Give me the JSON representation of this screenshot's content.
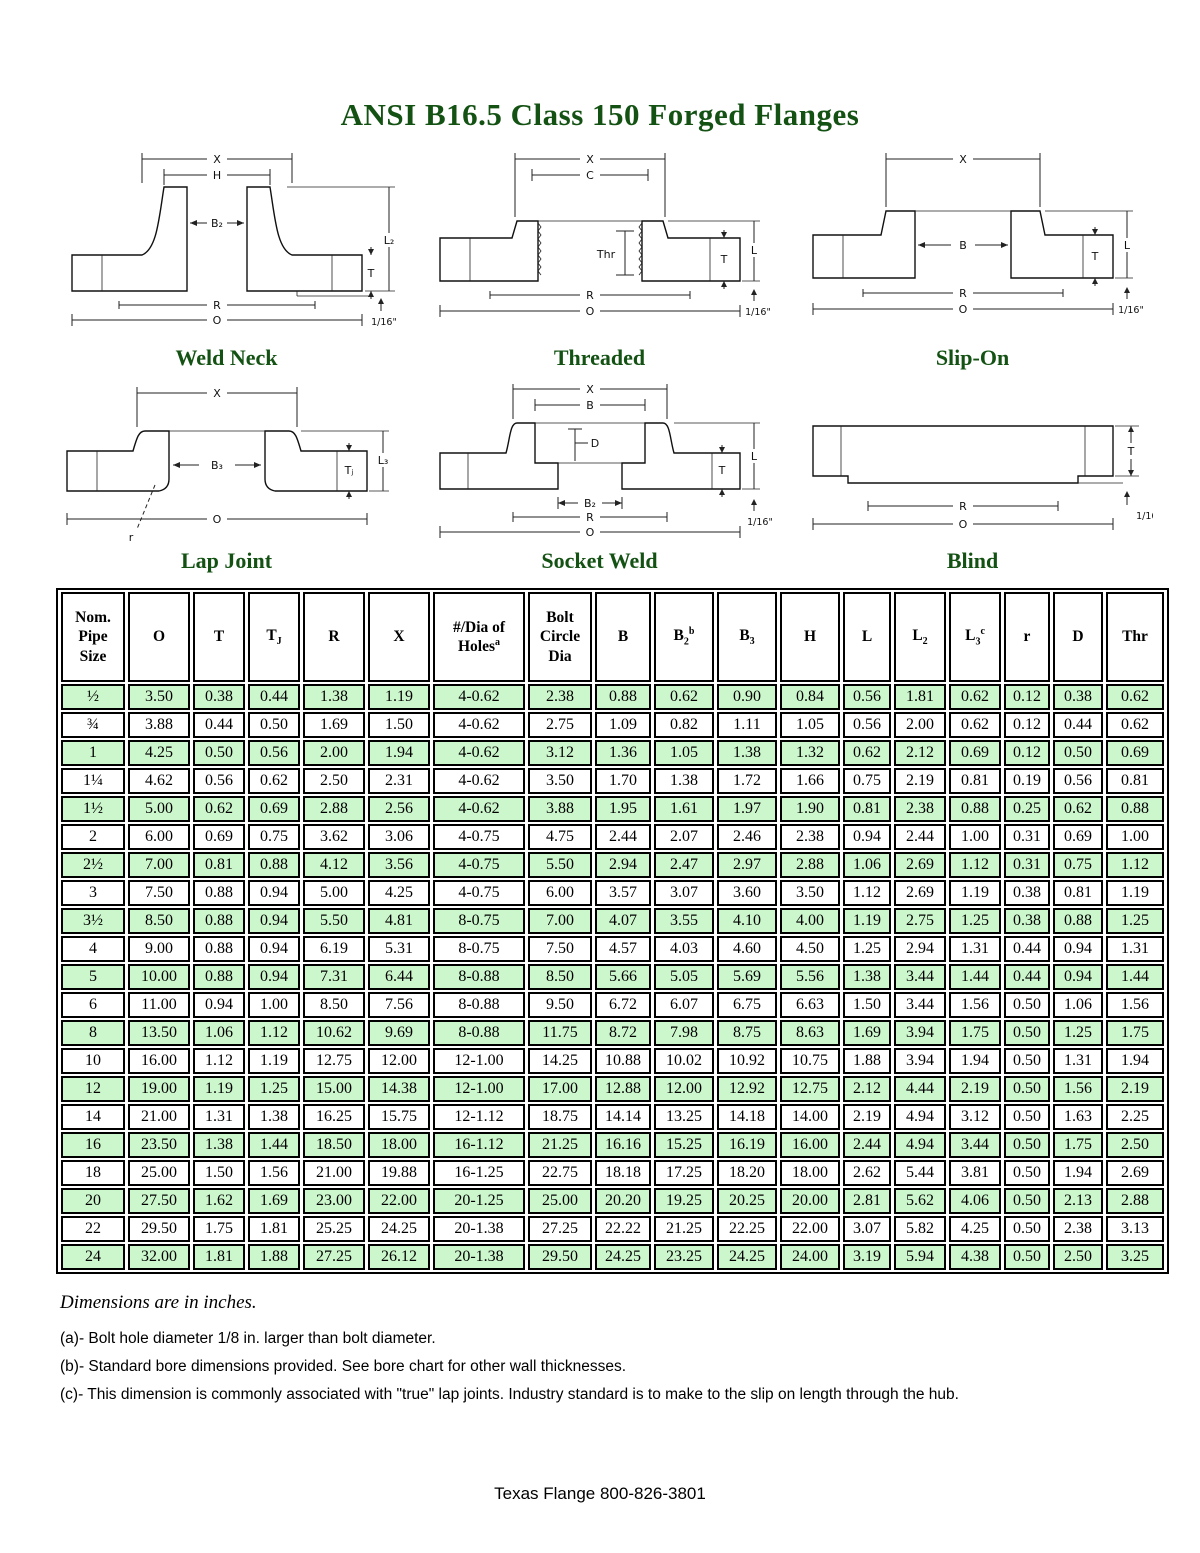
{
  "title": "ANSI B16.5 Class 150 Forged Flanges",
  "colors": {
    "heading_green": "#145214",
    "row_green": "#ccf7cc",
    "border": "#000000"
  },
  "diagrams": [
    {
      "caption": "Weld Neck",
      "labels": {
        "x": "X",
        "h": "H",
        "b2": "B₂",
        "l2": "L₂",
        "t": "T",
        "r": "R",
        "o": "O",
        "rf": "1/16\""
      }
    },
    {
      "caption": "Threaded",
      "labels": {
        "x": "X",
        "c": "C",
        "thr": "Thr",
        "t": "T",
        "l": "L",
        "r": "R",
        "o": "O",
        "rf": "1/16\""
      }
    },
    {
      "caption": "Slip-On",
      "labels": {
        "x": "X",
        "b": "B",
        "t": "T",
        "l": "L",
        "r": "R",
        "o": "O",
        "rf": "1/16\""
      }
    },
    {
      "caption": "Lap Joint",
      "labels": {
        "x": "X",
        "b3": "B₃",
        "tj": "Tⱼ",
        "l3": "L₃",
        "o": "O",
        "r": "r"
      }
    },
    {
      "caption": "Socket Weld",
      "labels": {
        "x": "X",
        "b": "B",
        "d": "D",
        "b2": "B₂",
        "r": "R",
        "o": "O",
        "t": "T",
        "l": "L",
        "rf": "1/16\""
      }
    },
    {
      "caption": "Blind",
      "labels": {
        "t": "T",
        "r": "R",
        "o": "O",
        "rf": "1/16\""
      }
    }
  ],
  "table": {
    "headers": [
      {
        "base": "Nom. Pipe Size"
      },
      {
        "base": "O"
      },
      {
        "base": "T"
      },
      {
        "base": "T",
        "sub": "J"
      },
      {
        "base": "R"
      },
      {
        "base": "X"
      },
      {
        "base": "#/Dia of Holes",
        "sup": "a"
      },
      {
        "base": "Bolt Circle Dia"
      },
      {
        "base": "B"
      },
      {
        "base": "B",
        "sub": "2",
        "sup": "b"
      },
      {
        "base": "B",
        "sub": "3"
      },
      {
        "base": "H"
      },
      {
        "base": "L"
      },
      {
        "base": "L",
        "sub": "2"
      },
      {
        "base": "L",
        "sub": "3",
        "sup": "c"
      },
      {
        "base": "r"
      },
      {
        "base": "D"
      },
      {
        "base": "Thr"
      }
    ],
    "rows": [
      [
        "½",
        "3.50",
        "0.38",
        "0.44",
        "1.38",
        "1.19",
        "4-0.62",
        "2.38",
        "0.88",
        "0.62",
        "0.90",
        "0.84",
        "0.56",
        "1.81",
        "0.62",
        "0.12",
        "0.38",
        "0.62"
      ],
      [
        "¾",
        "3.88",
        "0.44",
        "0.50",
        "1.69",
        "1.50",
        "4-0.62",
        "2.75",
        "1.09",
        "0.82",
        "1.11",
        "1.05",
        "0.56",
        "2.00",
        "0.62",
        "0.12",
        "0.44",
        "0.62"
      ],
      [
        "1",
        "4.25",
        "0.50",
        "0.56",
        "2.00",
        "1.94",
        "4-0.62",
        "3.12",
        "1.36",
        "1.05",
        "1.38",
        "1.32",
        "0.62",
        "2.12",
        "0.69",
        "0.12",
        "0.50",
        "0.69"
      ],
      [
        "1¼",
        "4.62",
        "0.56",
        "0.62",
        "2.50",
        "2.31",
        "4-0.62",
        "3.50",
        "1.70",
        "1.38",
        "1.72",
        "1.66",
        "0.75",
        "2.19",
        "0.81",
        "0.19",
        "0.56",
        "0.81"
      ],
      [
        "1½",
        "5.00",
        "0.62",
        "0.69",
        "2.88",
        "2.56",
        "4-0.62",
        "3.88",
        "1.95",
        "1.61",
        "1.97",
        "1.90",
        "0.81",
        "2.38",
        "0.88",
        "0.25",
        "0.62",
        "0.88"
      ],
      [
        "2",
        "6.00",
        "0.69",
        "0.75",
        "3.62",
        "3.06",
        "4-0.75",
        "4.75",
        "2.44",
        "2.07",
        "2.46",
        "2.38",
        "0.94",
        "2.44",
        "1.00",
        "0.31",
        "0.69",
        "1.00"
      ],
      [
        "2½",
        "7.00",
        "0.81",
        "0.88",
        "4.12",
        "3.56",
        "4-0.75",
        "5.50",
        "2.94",
        "2.47",
        "2.97",
        "2.88",
        "1.06",
        "2.69",
        "1.12",
        "0.31",
        "0.75",
        "1.12"
      ],
      [
        "3",
        "7.50",
        "0.88",
        "0.94",
        "5.00",
        "4.25",
        "4-0.75",
        "6.00",
        "3.57",
        "3.07",
        "3.60",
        "3.50",
        "1.12",
        "2.69",
        "1.19",
        "0.38",
        "0.81",
        "1.19"
      ],
      [
        "3½",
        "8.50",
        "0.88",
        "0.94",
        "5.50",
        "4.81",
        "8-0.75",
        "7.00",
        "4.07",
        "3.55",
        "4.10",
        "4.00",
        "1.19",
        "2.75",
        "1.25",
        "0.38",
        "0.88",
        "1.25"
      ],
      [
        "4",
        "9.00",
        "0.88",
        "0.94",
        "6.19",
        "5.31",
        "8-0.75",
        "7.50",
        "4.57",
        "4.03",
        "4.60",
        "4.50",
        "1.25",
        "2.94",
        "1.31",
        "0.44",
        "0.94",
        "1.31"
      ],
      [
        "5",
        "10.00",
        "0.88",
        "0.94",
        "7.31",
        "6.44",
        "8-0.88",
        "8.50",
        "5.66",
        "5.05",
        "5.69",
        "5.56",
        "1.38",
        "3.44",
        "1.44",
        "0.44",
        "0.94",
        "1.44"
      ],
      [
        "6",
        "11.00",
        "0.94",
        "1.00",
        "8.50",
        "7.56",
        "8-0.88",
        "9.50",
        "6.72",
        "6.07",
        "6.75",
        "6.63",
        "1.50",
        "3.44",
        "1.56",
        "0.50",
        "1.06",
        "1.56"
      ],
      [
        "8",
        "13.50",
        "1.06",
        "1.12",
        "10.62",
        "9.69",
        "8-0.88",
        "11.75",
        "8.72",
        "7.98",
        "8.75",
        "8.63",
        "1.69",
        "3.94",
        "1.75",
        "0.50",
        "1.25",
        "1.75"
      ],
      [
        "10",
        "16.00",
        "1.12",
        "1.19",
        "12.75",
        "12.00",
        "12-1.00",
        "14.25",
        "10.88",
        "10.02",
        "10.92",
        "10.75",
        "1.88",
        "3.94",
        "1.94",
        "0.50",
        "1.31",
        "1.94"
      ],
      [
        "12",
        "19.00",
        "1.19",
        "1.25",
        "15.00",
        "14.38",
        "12-1.00",
        "17.00",
        "12.88",
        "12.00",
        "12.92",
        "12.75",
        "2.12",
        "4.44",
        "2.19",
        "0.50",
        "1.56",
        "2.19"
      ],
      [
        "14",
        "21.00",
        "1.31",
        "1.38",
        "16.25",
        "15.75",
        "12-1.12",
        "18.75",
        "14.14",
        "13.25",
        "14.18",
        "14.00",
        "2.19",
        "4.94",
        "3.12",
        "0.50",
        "1.63",
        "2.25"
      ],
      [
        "16",
        "23.50",
        "1.38",
        "1.44",
        "18.50",
        "18.00",
        "16-1.12",
        "21.25",
        "16.16",
        "15.25",
        "16.19",
        "16.00",
        "2.44",
        "4.94",
        "3.44",
        "0.50",
        "1.75",
        "2.50"
      ],
      [
        "18",
        "25.00",
        "1.50",
        "1.56",
        "21.00",
        "19.88",
        "16-1.25",
        "22.75",
        "18.18",
        "17.25",
        "18.20",
        "18.00",
        "2.62",
        "5.44",
        "3.81",
        "0.50",
        "1.94",
        "2.69"
      ],
      [
        "20",
        "27.50",
        "1.62",
        "1.69",
        "23.00",
        "22.00",
        "20-1.25",
        "25.00",
        "20.20",
        "19.25",
        "20.25",
        "20.00",
        "2.81",
        "5.62",
        "4.06",
        "0.50",
        "2.13",
        "2.88"
      ],
      [
        "22",
        "29.50",
        "1.75",
        "1.81",
        "25.25",
        "24.25",
        "20-1.38",
        "27.25",
        "22.22",
        "21.25",
        "22.25",
        "22.00",
        "3.07",
        "5.82",
        "4.25",
        "0.50",
        "2.38",
        "3.13"
      ],
      [
        "24",
        "32.00",
        "1.81",
        "1.88",
        "27.25",
        "26.12",
        "20-1.38",
        "29.50",
        "24.25",
        "23.25",
        "24.25",
        "24.00",
        "3.19",
        "5.94",
        "4.38",
        "0.50",
        "2.50",
        "3.25"
      ]
    ]
  },
  "notes": {
    "dims": "Dimensions are in inches.",
    "a": "(a)-  Bolt hole diameter 1/8 in. larger than bolt diameter.",
    "b": "(b)-  Standard bore dimensions provided.  See bore chart for other wall thicknesses.",
    "c": "(c)-  This dimension is commonly associated with \"true\" lap joints.  Industry standard is to make to the slip on length through the hub."
  },
  "footer": "Texas Flange 800-826-3801"
}
